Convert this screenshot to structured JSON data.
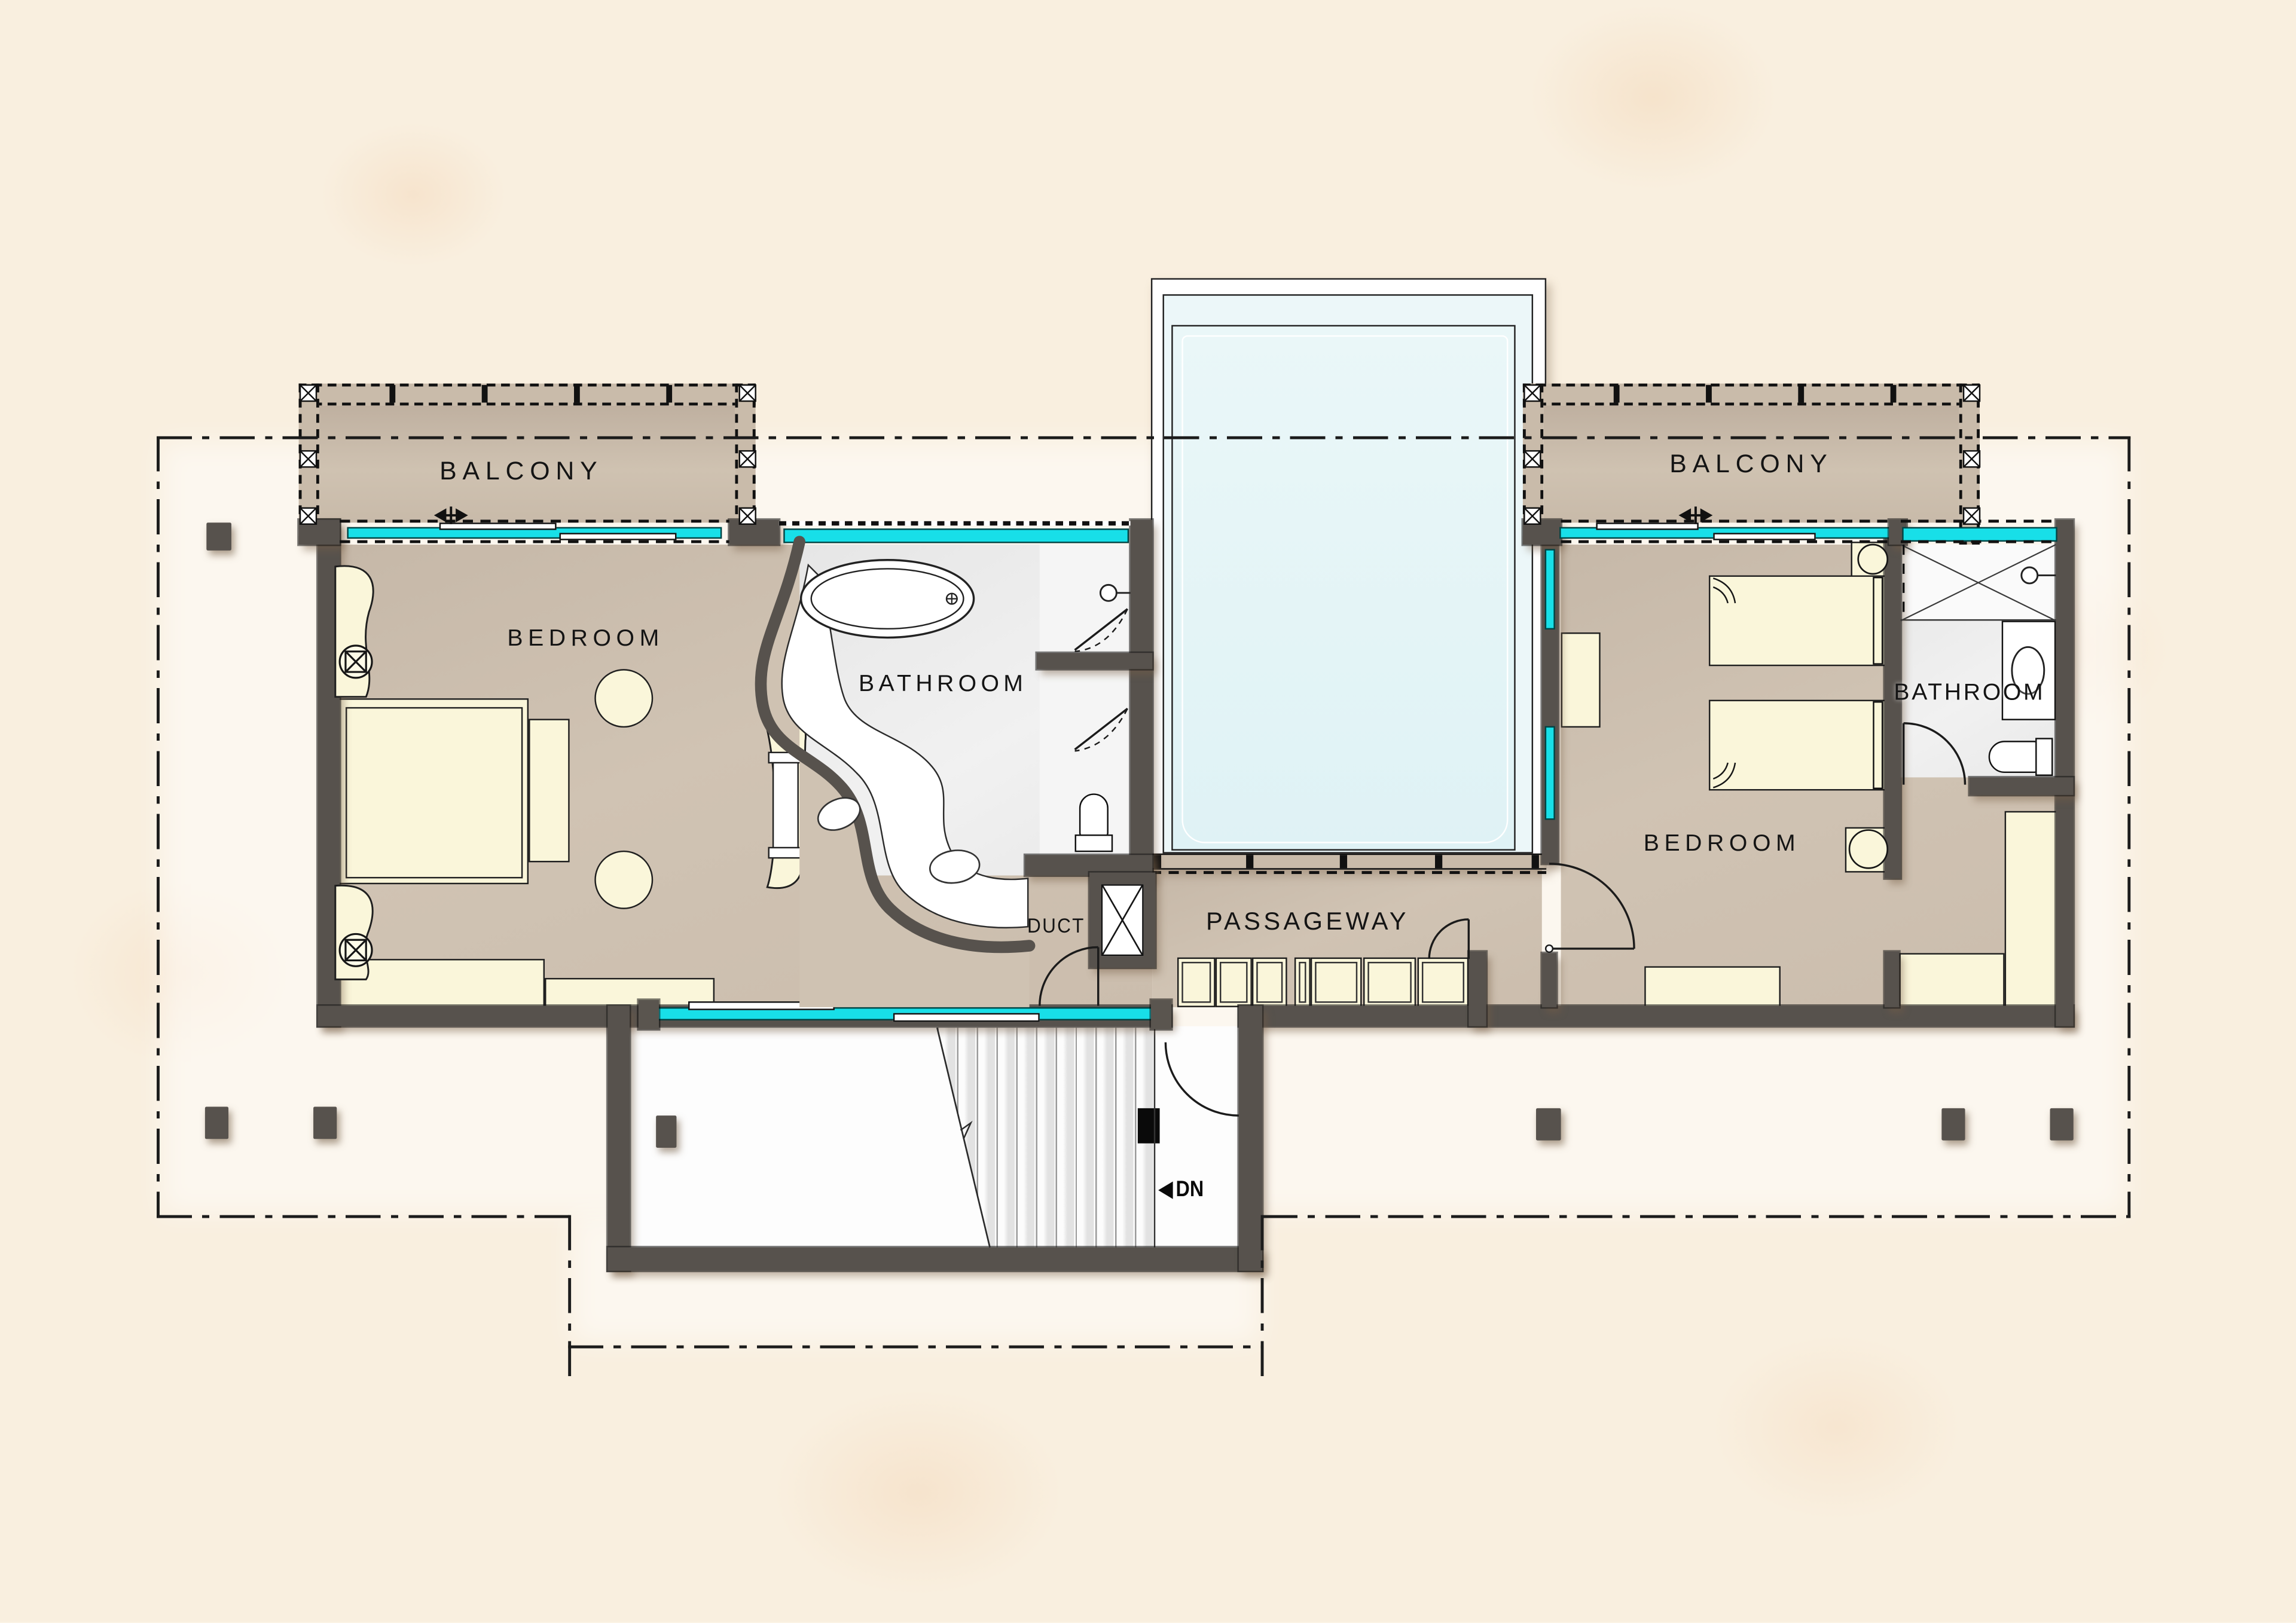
{
  "plan": {
    "type": "architectural-floor-plan",
    "floor": "upper floor with pool, two bedroom suites, stair down",
    "labels": {
      "balcony_left": "BALCONY",
      "balcony_right": "BALCONY",
      "bedroom_left": "BEDROOM",
      "bedroom_right": "BEDROOM",
      "bathroom_main": "BATHROOM",
      "bathroom_right": "BATHROOM",
      "passageway": "PASSAGEWAY",
      "duct": "DUCT",
      "stairs_down": "DN"
    },
    "colors": {
      "background": "#f9efdf",
      "wall": "#57524d",
      "floor_tan": "#cfc2b2",
      "balcony_tan": "#c9bbaa",
      "bath_floor": "#ededed",
      "furniture_cream": "#faf6da",
      "glass_cyan": "#18dfe8",
      "pool_water": "#e3f3f6",
      "line_black": "#1b1b1b"
    },
    "icons": {
      "duct_shaft": "x-box-icon",
      "ceiling_lamp": "circle-cross-icon",
      "shower_tray": "x-cross-icon",
      "stairs_direction": "left-arrow-icon",
      "railing_marker": "x-box-icon",
      "sliding_door": "double-arrow-icon"
    },
    "annotations": {
      "boundary": "dash-dot roof overhang outline",
      "grid_line": "horizontal dash-dot line through balconies and pool"
    }
  }
}
